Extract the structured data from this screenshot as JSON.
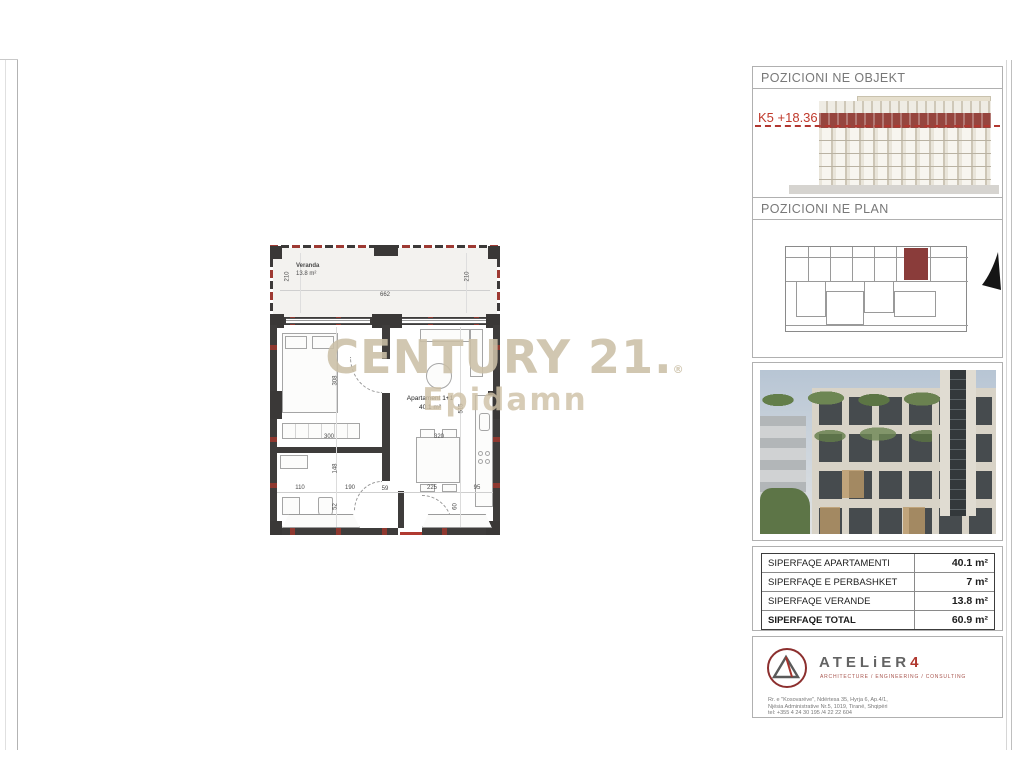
{
  "watermark": {
    "brand": "CENTURY 21",
    "brand_period": ".",
    "reg": "®",
    "name": "Epidamn"
  },
  "plan": {
    "veranda_label": "Veranda",
    "veranda_area": "13.8 m²",
    "unit_label": "Apartament 1+1",
    "unit_area": "40.1 m²",
    "dims": {
      "v_left": "210",
      "v_width": "662",
      "v_right": "210",
      "bed_h": "308",
      "bed_w": "300",
      "liv_h": "515",
      "kit_w": "320",
      "b1": "110",
      "b2": "190",
      "b3": "59",
      "b4": "225",
      "b5": "95",
      "m1": "148",
      "m2": "52",
      "m3": "60"
    }
  },
  "sidebar": {
    "objekt": {
      "title": "POZICIONI NE OBJEKT",
      "level_label": "K5 +18.36"
    },
    "plan_panel": {
      "title": "POZICIONI NE PLAN"
    },
    "areas": {
      "rows": [
        {
          "label": "SIPERFAQE APARTAMENTI",
          "value": "40.1 m²"
        },
        {
          "label": "SIPERFAQE E PERBASHKET",
          "value": "7 m²"
        },
        {
          "label": "SIPERFAQE VERANDE",
          "value": "13.8 m²"
        },
        {
          "label": "SIPERFAQE TOTAL",
          "value": "60.9 m²"
        }
      ]
    },
    "firm": {
      "name": "ATELiER",
      "four": "4",
      "subtitle": "ARCHITECTURE / ENGINEERING / CONSULTING",
      "address_line1": "Rr. e \"Kosovarëve\", Ndërtesa 35, Hyrja 6, Ap.4/1,",
      "address_line2": "Njësia Administrative Nr.5, 1019, Tiranë, Shqipëri",
      "address_line3": "tel: +355 4 24 30 195 /4 22 22 604"
    }
  },
  "colors": {
    "accent_red": "#b03a31",
    "highlight_maroon": "#8a3c3a",
    "wall_dark": "#3e3c3b",
    "watermark_tan": "#d7cfc0"
  }
}
